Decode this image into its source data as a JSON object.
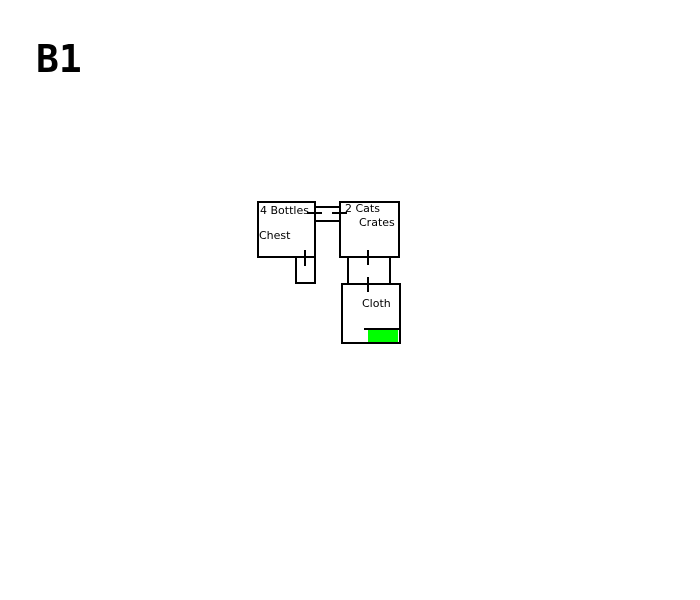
{
  "floor_label": "B1",
  "colors": {
    "line": "#000000",
    "background": "#ffffff",
    "exit_highlight": "#00ff00"
  },
  "rooms": {
    "bottles_chest": {
      "labels": [
        "4 Bottles",
        "Chest"
      ]
    },
    "cats_crates": {
      "labels": [
        "2 Cats",
        "Crates"
      ]
    },
    "cloth": {
      "labels": [
        "Cloth"
      ]
    },
    "annex": {
      "labels": []
    }
  }
}
